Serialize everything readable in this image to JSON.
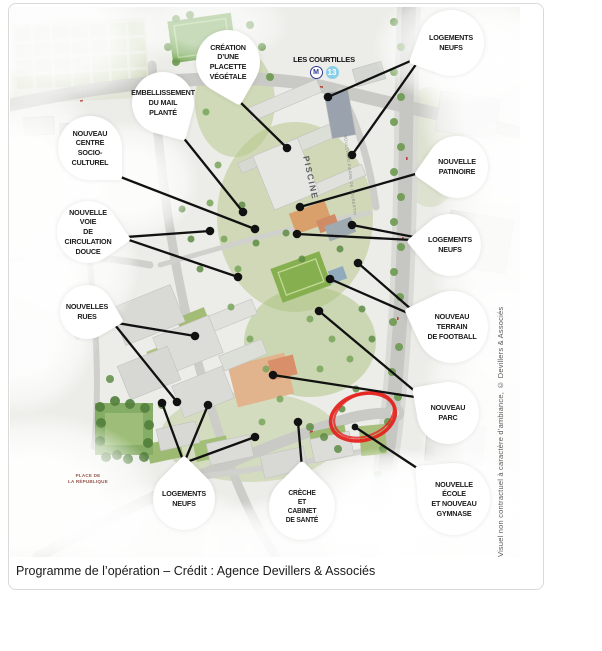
{
  "figure": {
    "caption": "Programme de l’opération – Crédit : Agence Devillers & Associés",
    "credit_vertical": "Visuel non contractuel à caractère d’ambiance, © Devillers & Associés"
  },
  "map": {
    "station": {
      "name": "LES COURTILLES",
      "metro_logo": "M",
      "line_number": "13",
      "line_color": "#89cfe9",
      "metro_blue": "#2b3990"
    },
    "labels": {
      "pool": "PISCINE",
      "square": [
        "PLACE DE",
        "LA RÉPUBLIQUE"
      ],
      "street": "BOULEVARD PIERRE DE COUBERTIN"
    },
    "annotation": {
      "shape": "hand-drawn red ellipse",
      "color": "#e52420"
    },
    "callouts": [
      {
        "id": "placette",
        "label": [
          "CRÉATION",
          "D’UNE PLACETTE",
          "VÉGÉTALE"
        ]
      },
      {
        "id": "embellissement",
        "label": [
          "EMBELLISSEMENT",
          "DU MAIL",
          "PLANTÉ"
        ]
      },
      {
        "id": "socio-culturel",
        "label": [
          "NOUVEAU CENTRE",
          "SOCIO-CULTUREL"
        ]
      },
      {
        "id": "voie-douce",
        "label": [
          "NOUVELLE VOIE",
          "DE CIRCULATION",
          "DOUCE"
        ]
      },
      {
        "id": "nouvelles-rues",
        "label": [
          "NOUVELLES",
          "RUES"
        ]
      },
      {
        "id": "logements-sud",
        "label": [
          "LOGEMENTS",
          "NEUFS"
        ]
      },
      {
        "id": "creche",
        "label": [
          "CRÈCHE",
          "ET",
          "CABINET",
          "DE SANTÉ"
        ]
      },
      {
        "id": "ecole-gymnase",
        "label": [
          "NOUVELLE ÉCOLE",
          "ET NOUVEAU",
          "GYMNASE"
        ]
      },
      {
        "id": "parc",
        "label": [
          "NOUVEAU",
          "PARC"
        ]
      },
      {
        "id": "football",
        "label": [
          "NOUVEAU TERRAIN",
          "DE FOOTBALL"
        ]
      },
      {
        "id": "logements-est",
        "label": [
          "LOGEMENTS",
          "NEUFS"
        ]
      },
      {
        "id": "patinoire",
        "label": [
          "NOUVELLE",
          "PATINOIRE"
        ]
      },
      {
        "id": "logements-nord",
        "label": [
          "LOGEMENTS",
          "NEUFS"
        ]
      }
    ]
  }
}
